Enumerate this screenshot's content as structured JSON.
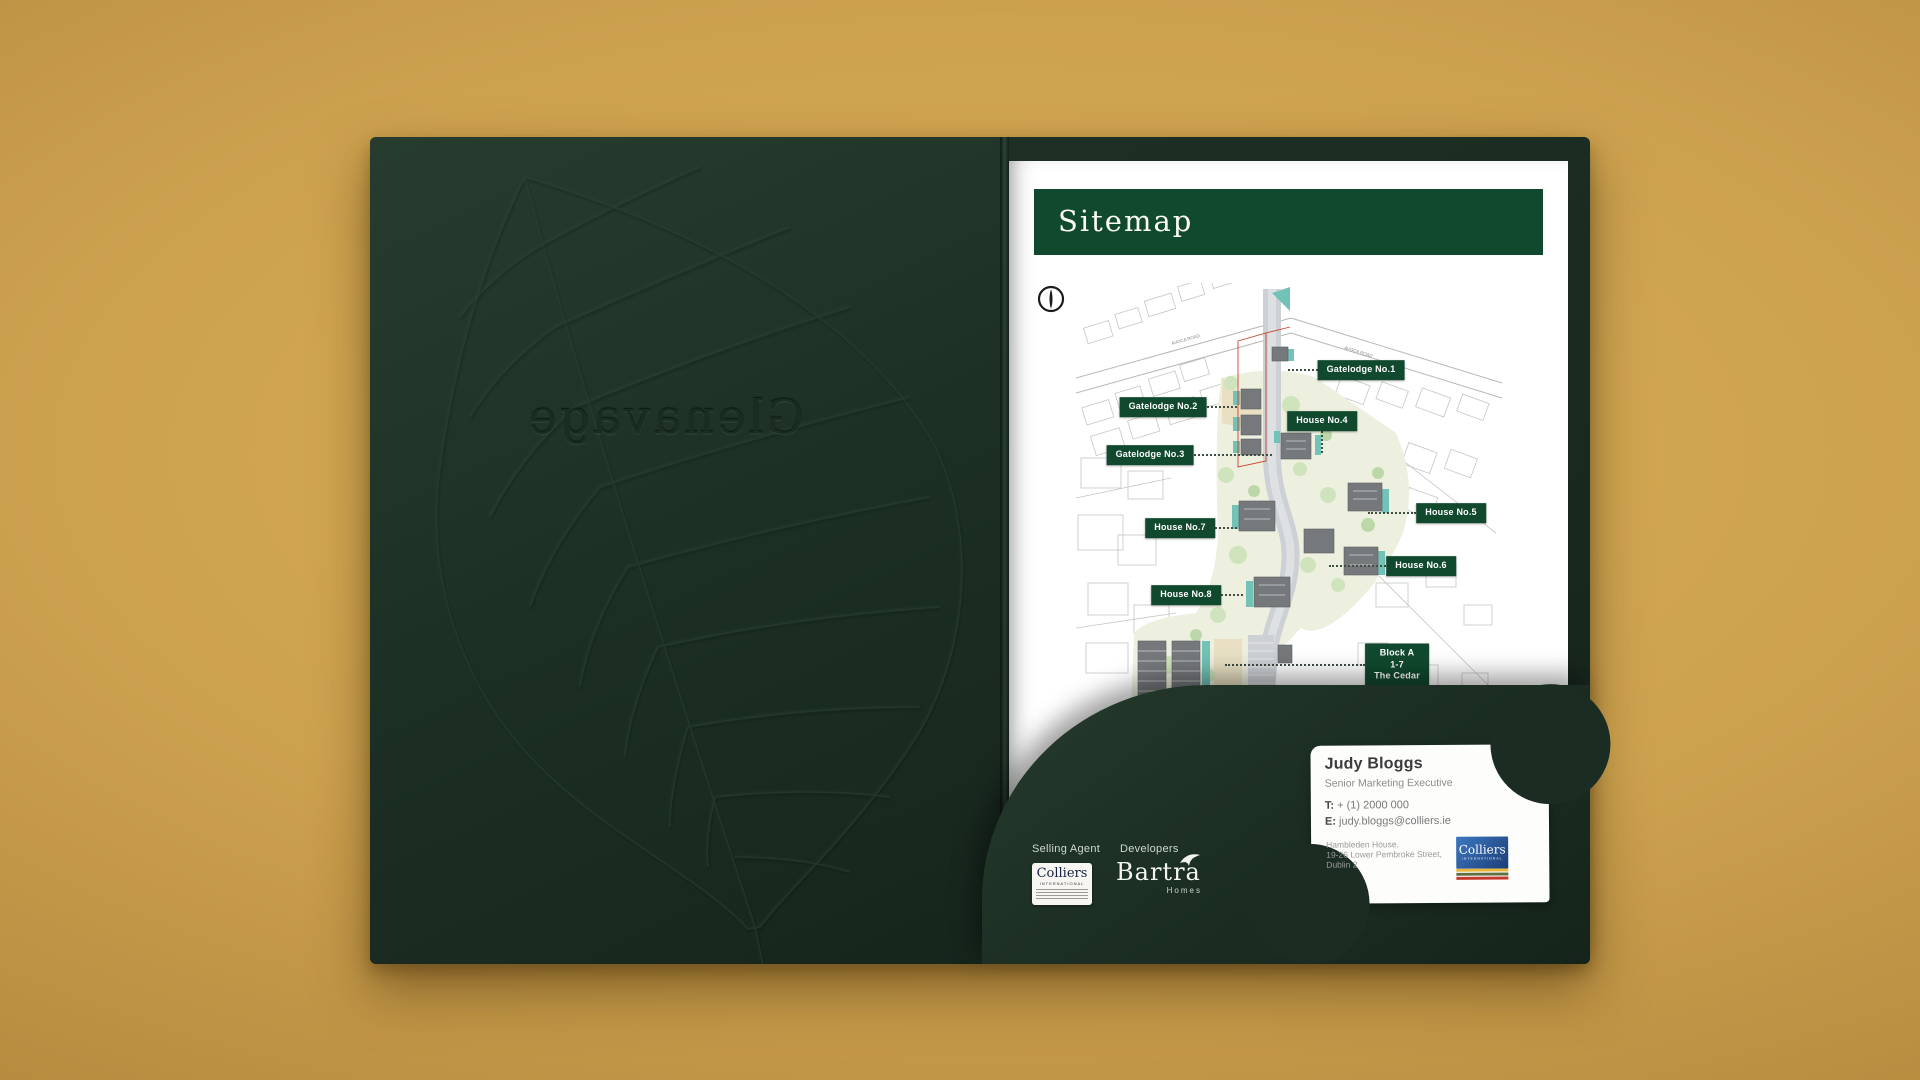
{
  "folder": {
    "embossed_brand": "Glenavage"
  },
  "sitemap_page": {
    "title": "Sitemap",
    "road_label_left": "AVOCA ROAD",
    "road_label_right": "AVOCA ROAD",
    "labels": [
      {
        "lines": [
          "Gatelodge No.1"
        ],
        "x": 285,
        "y": 87,
        "dir": "left",
        "len": 30
      },
      {
        "lines": [
          "Gatelodge No.2"
        ],
        "x": 87,
        "y": 124,
        "dir": "right",
        "len": 30
      },
      {
        "lines": [
          "Gatelodge No.3"
        ],
        "x": 74,
        "y": 172,
        "dir": "right",
        "len": 78
      },
      {
        "lines": [
          "House No.4"
        ],
        "x": 246,
        "y": 138,
        "dir": "down",
        "len": 22
      },
      {
        "lines": [
          "House No.5"
        ],
        "x": 375,
        "y": 230,
        "dir": "left",
        "len": 48
      },
      {
        "lines": [
          "House No.7"
        ],
        "x": 104,
        "y": 245,
        "dir": "right",
        "len": 22
      },
      {
        "lines": [
          "House No.6"
        ],
        "x": 345,
        "y": 283,
        "dir": "left",
        "len": 57
      },
      {
        "lines": [
          "House No.8"
        ],
        "x": 110,
        "y": 312,
        "dir": "right",
        "len": 22
      },
      {
        "lines": [
          "Block A",
          "1-7",
          "The Cedar"
        ],
        "x": 321,
        "y": 382,
        "dir": "left",
        "len": 140
      }
    ]
  },
  "pocket": {
    "selling_agent_heading": "Selling Agent",
    "developers_heading": "Developers",
    "colliers_box": {
      "name": "Colliers",
      "subtitle": "INTERNATIONAL"
    },
    "bartra": {
      "name": "Bartra",
      "subtitle": "Homes"
    }
  },
  "card": {
    "name": "Judy Bloggs",
    "role": "Senior Marketing Executive",
    "phone_label": "T:",
    "phone": " + (1) 2000 000",
    "email_label": "E:",
    "email": " judy.bloggs@colliers.ie",
    "address": [
      "Hambleden House,",
      "19-26 Lower Pembroke Street,",
      "Dublin 2"
    ],
    "logo": {
      "name": "Colliers",
      "subtitle": "INTERNATIONAL"
    }
  },
  "colors": {
    "background_gold": "#cda24f",
    "folder_green": "#1d3025",
    "banner_green": "#11492f",
    "map_teal": "#72c2b8",
    "site_boundary_red": "#c9452f",
    "colliers_blue": "#1c3e78"
  }
}
